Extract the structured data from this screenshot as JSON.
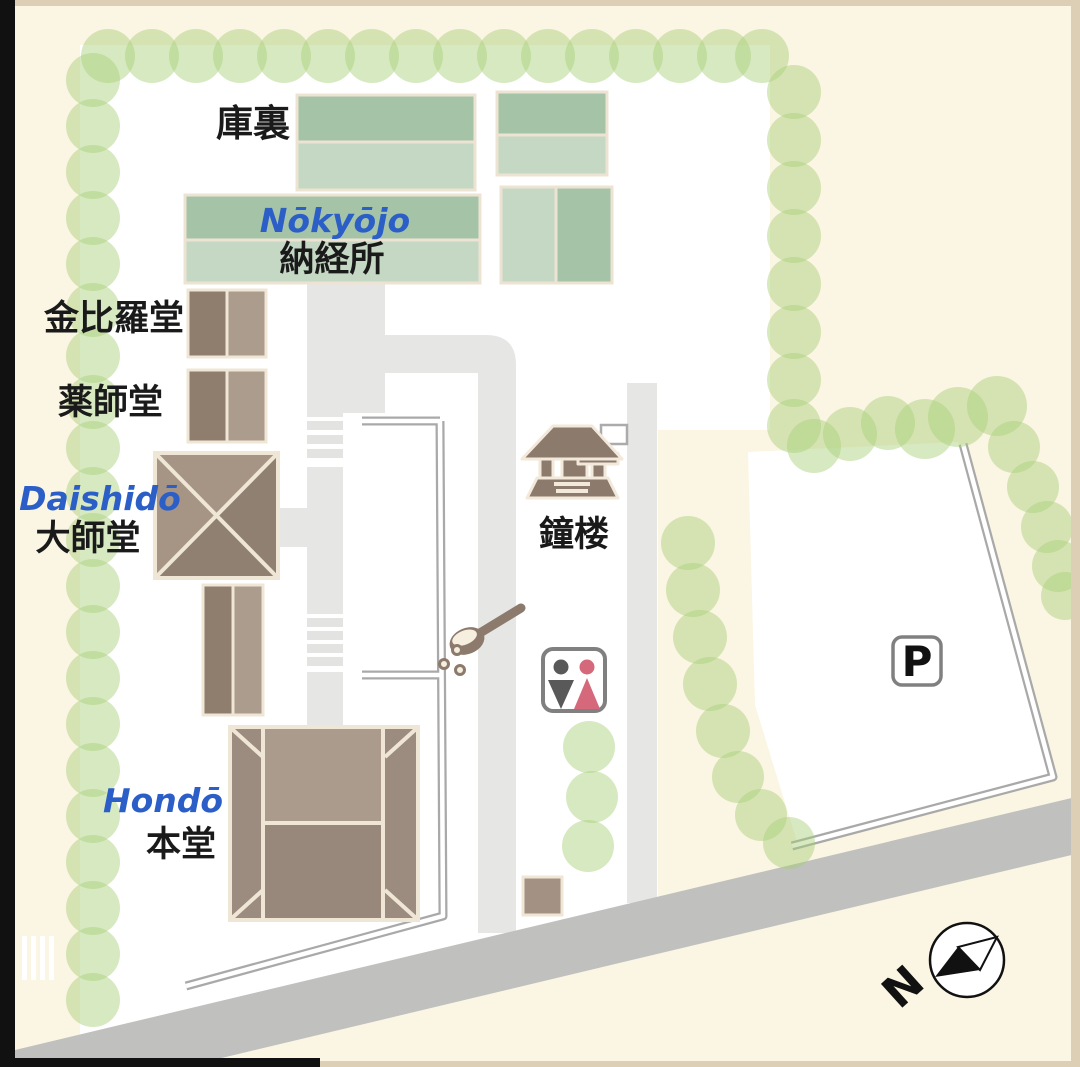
{
  "map": {
    "labels": {
      "kuri_jp": "庫裏",
      "nokyojo_romaji": "Nōkyōjo",
      "nokyojo_jp": "納経所",
      "konpirado_jp": "金比羅堂",
      "yakushido_jp": "薬師堂",
      "daishido_romaji": "Daishidō",
      "daishido_jp": "大師堂",
      "shoro_jp": "鐘楼",
      "hondo_romaji": "Hondō",
      "hondo_jp": "本堂",
      "parking": "P",
      "north": "N"
    },
    "icons": {
      "bell_tower": "bell-tower-icon",
      "water_ladle": "water-ladle-icon",
      "toilet": "toilet-icon",
      "parking": "parking-icon",
      "compass": "compass-icon"
    },
    "colors": {
      "background_cream": "#FBF5E3",
      "grounds_white": "#FFFFFF",
      "tree_green": "#A7CF76",
      "building_green_dark": "#A5C3A7",
      "building_green_light": "#C5D8C4",
      "building_brown_dark": "#8F7D6E",
      "building_brown_light": "#AC9C8D",
      "hondo_roof_light": "#AB9B8C",
      "hondo_roof_dark": "#97887B",
      "building_outline_cream": "#EFE6D6",
      "path_grey": "#E6E6E4",
      "road_grey": "#C0C0BE",
      "wall_grey": "#A9A9A9",
      "label_blue": "#2B5FC7",
      "label_black": "#1A1A1A",
      "toilet_male_grey": "#595959",
      "toilet_female_red": "#D5697B",
      "icon_brown": "#8C7A6D",
      "frame_black": "#111111",
      "frame_tan": "#DCCFB5"
    }
  }
}
